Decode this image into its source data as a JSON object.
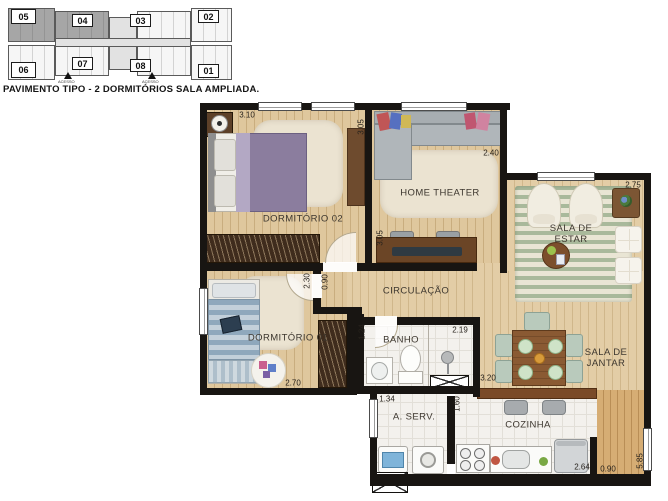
{
  "keyplan": {
    "units": {
      "u05": "05",
      "u04": "04",
      "u03": "03",
      "u02": "02",
      "u06": "06",
      "u07": "07",
      "u08": "08",
      "u01": "01"
    },
    "access_left": "ACESSO",
    "access_right": "ACESSO"
  },
  "title": "PAVIMENTO TIPO - 2 DORMITÓRIOS SALA AMPLIADA.",
  "rooms": {
    "dormitorio_02": "DORMITÓRIO 02",
    "home_theater": "HOME THEATER",
    "sala_de_estar": "SALA DE ESTAR",
    "circulacao": "CIRCULAÇÃO",
    "dormitorio_01": "DORMITÓRIO 01",
    "banho": "BANHO",
    "sala_de_jantar": "SALA DE JANTAR",
    "area_servico": "A. SERV.",
    "cozinha": "COZINHA"
  },
  "dims": {
    "dorm2_width": "3.10",
    "ht_depth_top": "3.05",
    "ht_width": "2.40",
    "ht_depth_bottom": "3.05",
    "estar_width": "2.75",
    "dorm1_depth": "2.30",
    "hall_width": "0.90",
    "dorm1_width": "2.70",
    "banho_depth": "1.24",
    "banho_width": "2.19",
    "aserv_width": "1.34",
    "aserv_depth": "1.60",
    "jantar_width": "3.20",
    "cozinha_width": "2.64",
    "deck_width": "0.90",
    "side_depth": "5.85"
  },
  "colors": {
    "wall": "#181512",
    "wood_floor": "#dfc79d",
    "tile_floor": "#f3f1ed",
    "rug_green": "#a9b99b",
    "bed_purple": "#8b7d9e",
    "counter_wood": "#7a4a28"
  }
}
